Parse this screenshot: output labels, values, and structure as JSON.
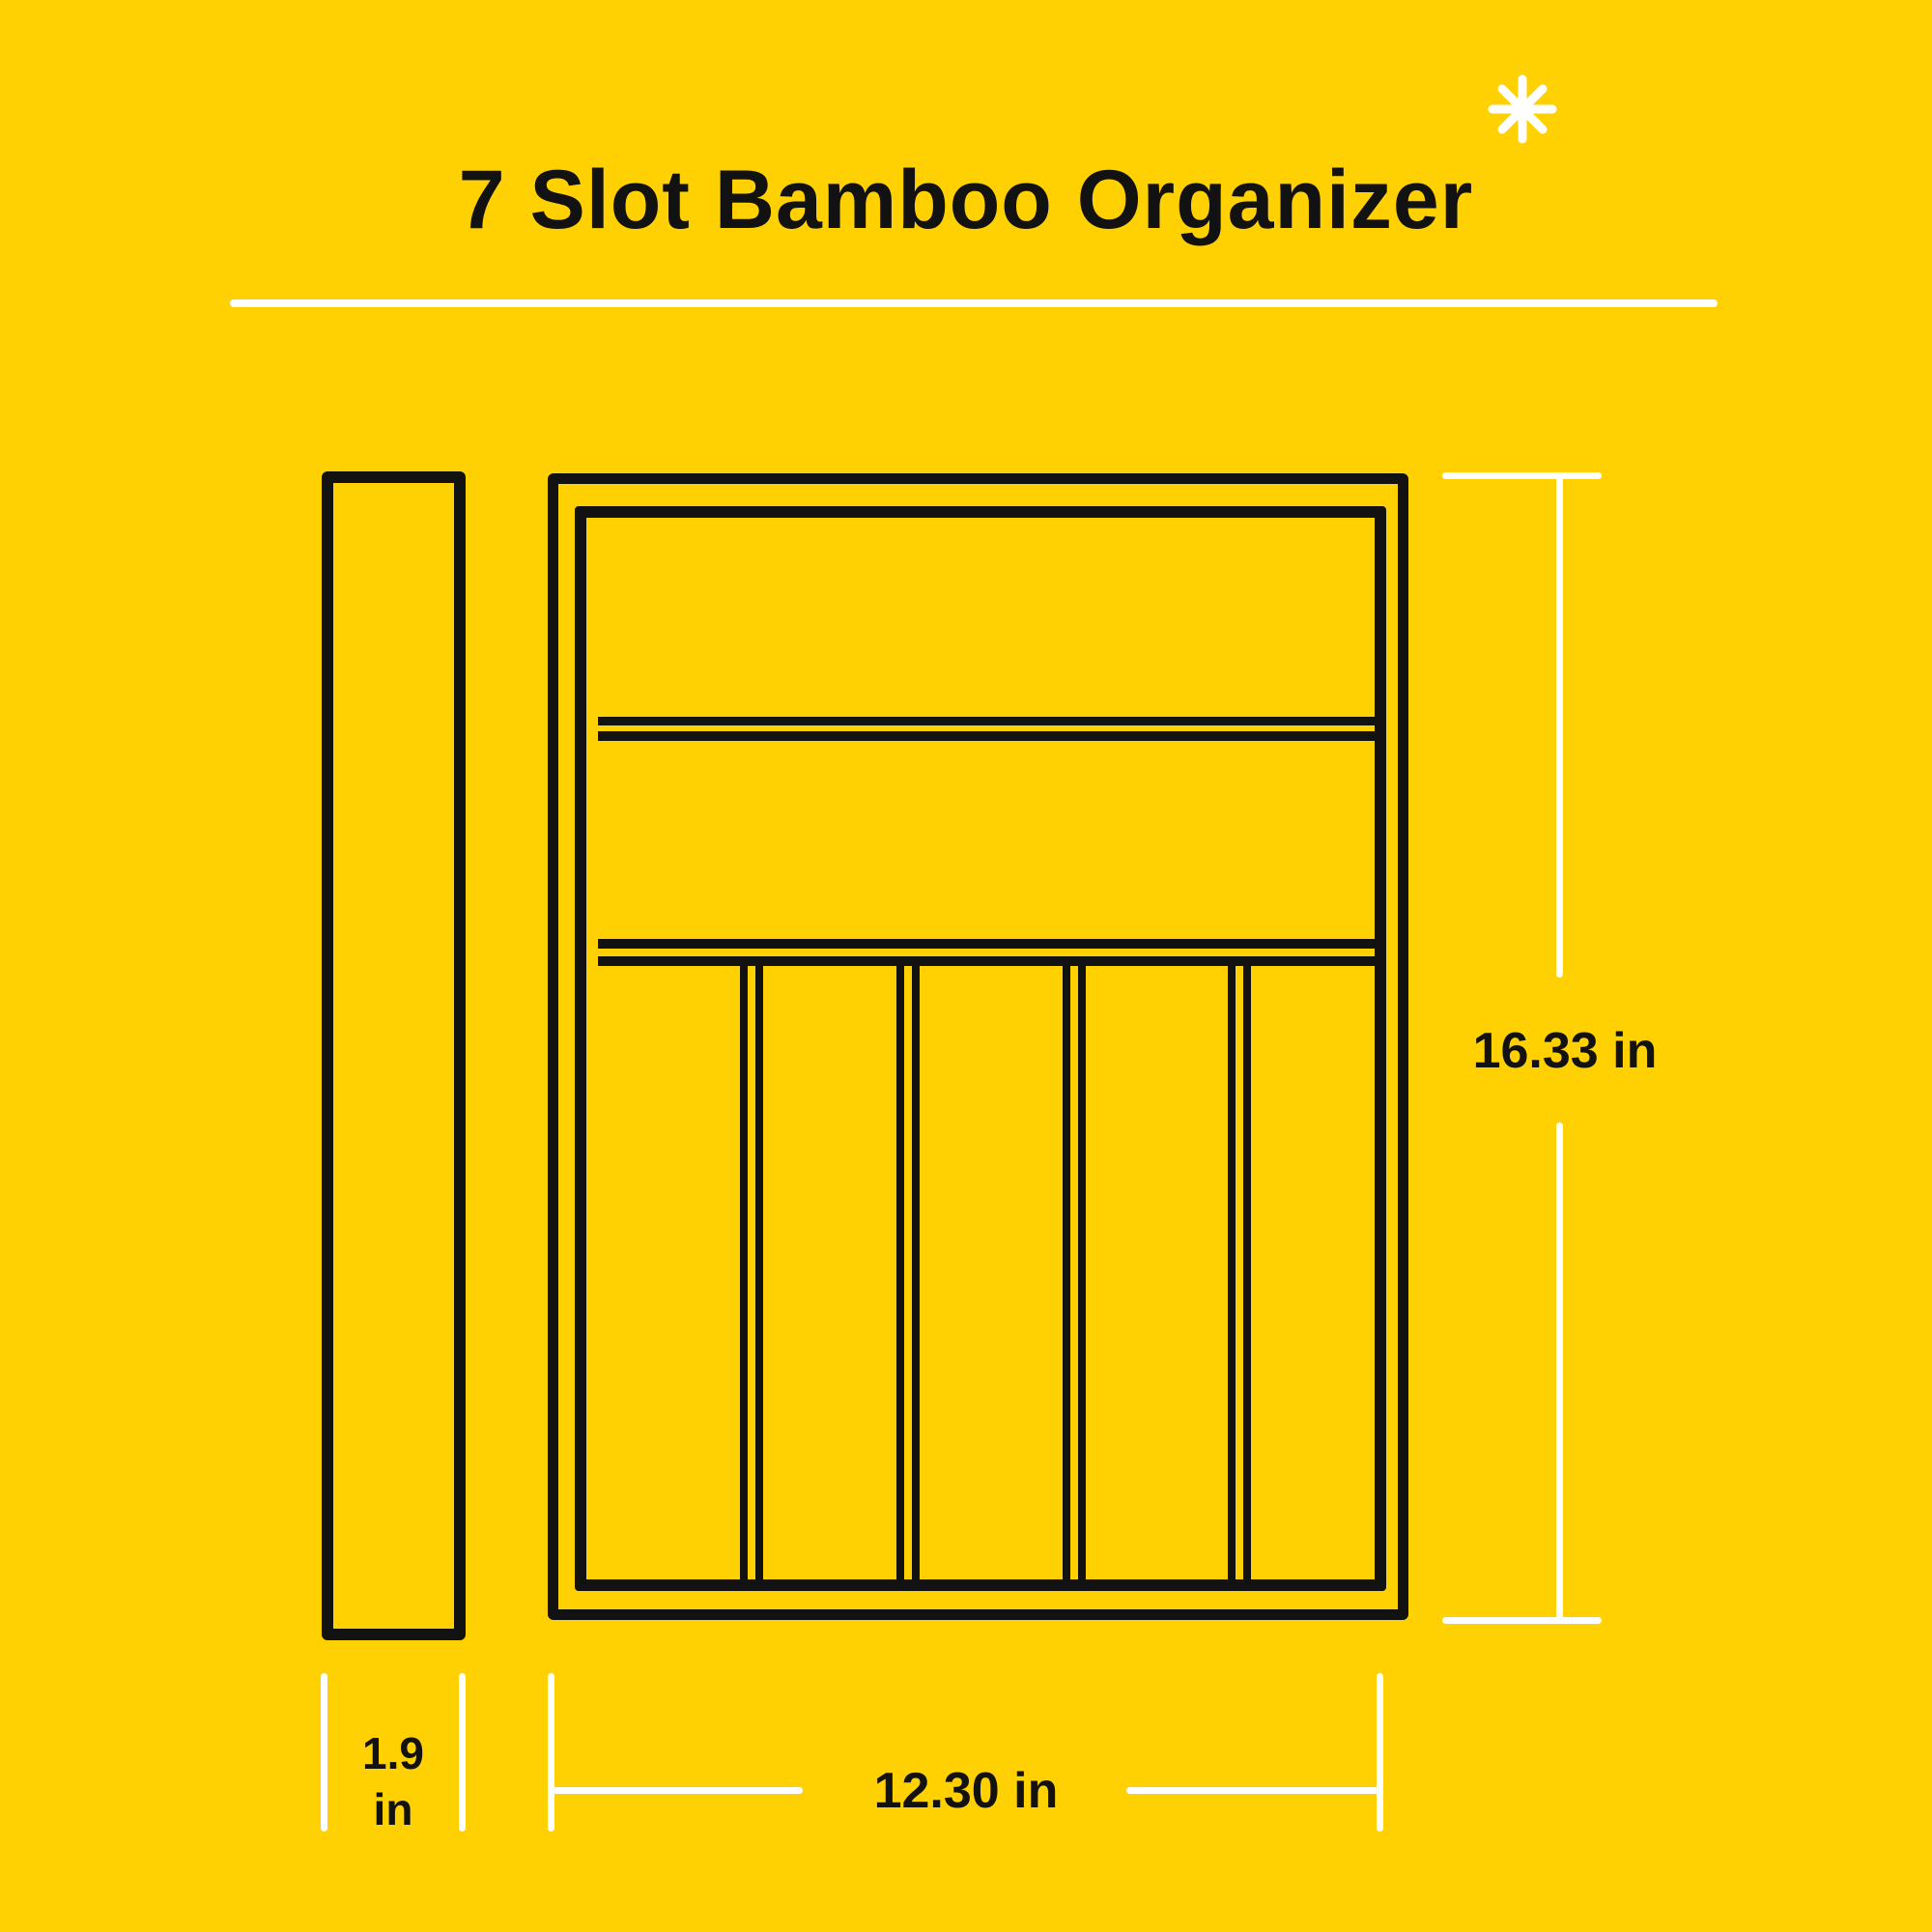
{
  "title": "7 Slot Bamboo Organizer",
  "icons": {
    "asterisk": "8-spoke star"
  },
  "dimensions": {
    "height_label": "16.33 in",
    "width_label": "12.30 in",
    "depth_value": "1.9",
    "depth_unit": "in"
  },
  "diagram": {
    "slot_count": 7,
    "views": [
      "side-profile",
      "top-down"
    ],
    "horizontal_compartments": 2,
    "vertical_slots": 5,
    "slot_divider_centers": [
      171,
      333,
      505,
      676
    ]
  },
  "colors": {
    "background": "#FFD103",
    "outline": "#121212",
    "dimension_line": "#FFFFFF",
    "text": "#161616"
  }
}
